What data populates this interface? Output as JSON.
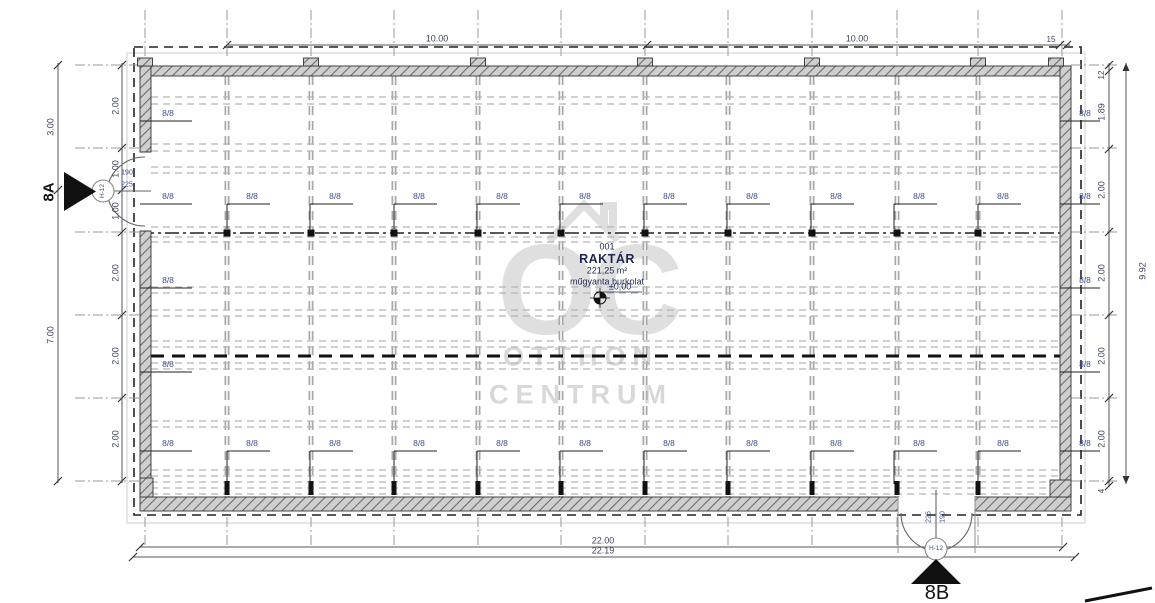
{
  "room": {
    "number": "001",
    "name": "RAKTÁR",
    "area": "221,25 m²",
    "floor_finish": "műgyanta burkolat",
    "level": "±0,00"
  },
  "unit_label": "8/8",
  "unit_positions": [
    [
      168,
      113
    ],
    [
      1085,
      113
    ],
    [
      168,
      196
    ],
    [
      252,
      196
    ],
    [
      335,
      196
    ],
    [
      419,
      196
    ],
    [
      502,
      196
    ],
    [
      585,
      196
    ],
    [
      669,
      196
    ],
    [
      752,
      196
    ],
    [
      836,
      196
    ],
    [
      919,
      196
    ],
    [
      1003,
      196
    ],
    [
      1085,
      196
    ],
    [
      168,
      280
    ],
    [
      1085,
      280
    ],
    [
      168,
      364
    ],
    [
      1085,
      364
    ],
    [
      168,
      443
    ],
    [
      252,
      443
    ],
    [
      335,
      443
    ],
    [
      419,
      443
    ],
    [
      502,
      443
    ],
    [
      585,
      443
    ],
    [
      669,
      443
    ],
    [
      752,
      443
    ],
    [
      836,
      443
    ],
    [
      919,
      443
    ],
    [
      1003,
      443
    ],
    [
      1085,
      443
    ]
  ],
  "dims": {
    "top": [
      "10.00",
      "10.00",
      "15"
    ],
    "bottom": [
      "22.00",
      "22.19"
    ],
    "left_outer": [
      "3.00",
      "7.00"
    ],
    "left_inner": [
      "2.00",
      "1.00",
      "1.00",
      "2.00",
      "2.00",
      "2.00"
    ],
    "right_inner": [
      "12",
      "1.89",
      "2.00",
      "2.00",
      "2.00",
      "2.00",
      "4"
    ],
    "right_outer": "9.92"
  },
  "doors": {
    "tag": "H-12",
    "left_width": "190",
    "left_height": "225",
    "bottom_width": "225",
    "bottom_height": "190"
  },
  "sections": {
    "a": "8A",
    "b": "8B"
  },
  "watermark": {
    "logo": "OC",
    "line1": "OTTHON",
    "line2": "CENTRUM"
  },
  "colors": {
    "line_dark": "#222222",
    "grid_gray": "#a0a0a0",
    "dim_text": "#3f465c",
    "unit_text": "#3f4f8f",
    "room_text": "#1d2750",
    "watermark": "#c6c6c6",
    "wall_hatch": "#cfcfcf"
  }
}
